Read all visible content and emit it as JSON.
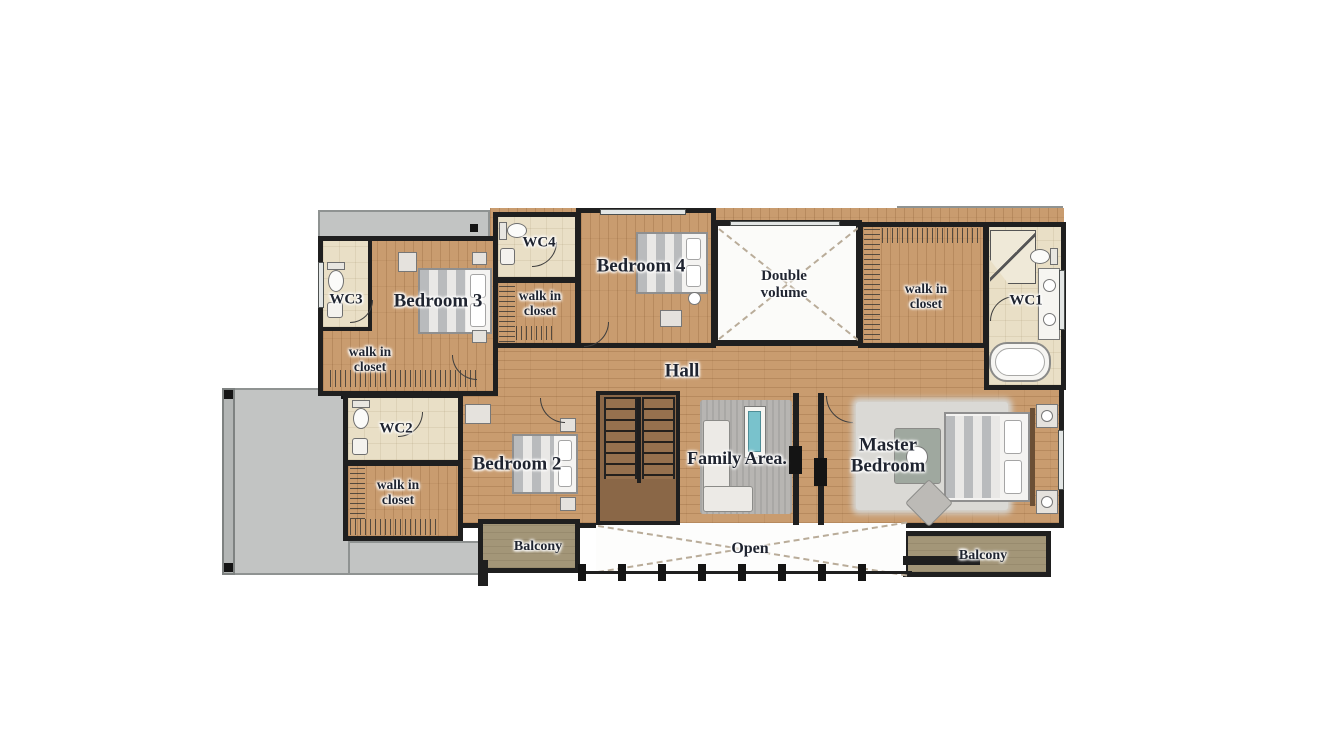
{
  "figure": "second-floor-house-plan",
  "rooms": {
    "wc3": {
      "label": "WC3"
    },
    "bedroom3": {
      "label": "Bedroom 3"
    },
    "closet3": {
      "label": "walk in closet"
    },
    "wc4": {
      "label": "WC4"
    },
    "closet4": {
      "label": "walk in closet"
    },
    "bedroom4": {
      "label": "Bedroom 4"
    },
    "double_volume": {
      "label": "Double volume"
    },
    "closet_master": {
      "label": "walk in closet"
    },
    "wc1": {
      "label": "WC1"
    },
    "hall": {
      "label": "Hall"
    },
    "wc2": {
      "label": "WC2"
    },
    "closet2": {
      "label": "walk in closet"
    },
    "bedroom2": {
      "label": "Bedroom 2"
    },
    "family": {
      "label": "Family Area."
    },
    "master": {
      "label": "Master Bedroom"
    },
    "balcony_left": {
      "label": "Balcony"
    },
    "open": {
      "label": "Open"
    },
    "balcony_right": {
      "label": "Balcony"
    }
  },
  "colors": {
    "wall": "#1f1f1f",
    "wood_floor": "#c99c6f",
    "bath_floor": "#e9dfc6",
    "roof_gray": "#c2c4c3",
    "balcony_floor": "#a39678",
    "label_text": "#1f2430",
    "tv_screen": "#79c2cc"
  }
}
